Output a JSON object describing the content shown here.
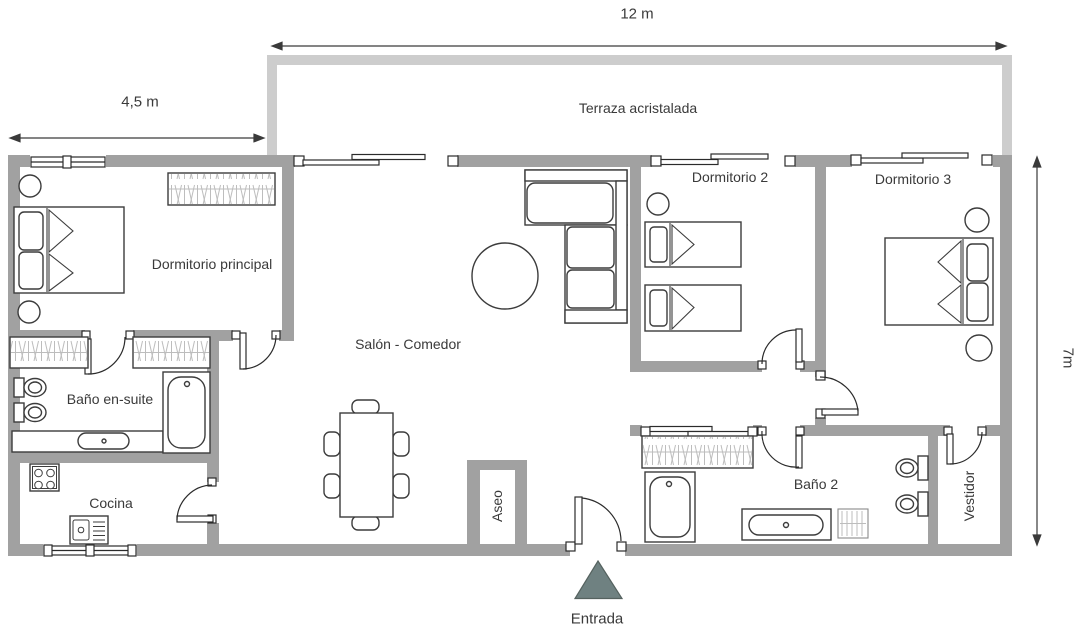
{
  "floorplan": {
    "dimension_labels": {
      "terrace_width": "12 m",
      "master_width": "4,5 m",
      "plan_height": "7m"
    },
    "room_labels": {
      "terrace": "Terraza acristalada",
      "master_bedroom": "Dormitorio principal",
      "living_dining": "Salón - Comedor",
      "ensuite_bath": "Baño en-suite",
      "kitchen": "Cocina",
      "guest_toilet": "Aseo",
      "bedroom_2": "Dormitorio 2",
      "bedroom_3": "Dormitorio 3",
      "bathroom_2": "Baño 2",
      "dressing_room": "Vestidor"
    },
    "entrance_label": "Entrada",
    "colors": {
      "wall": "#a1a1a1",
      "terrace_wall": "#cdcdcd",
      "fixture_outline": "#3c3c3c",
      "hanger_lines": "#bdbdbd",
      "entrance_marker": "#6f8181",
      "label_text": "#3a3a3a"
    }
  }
}
